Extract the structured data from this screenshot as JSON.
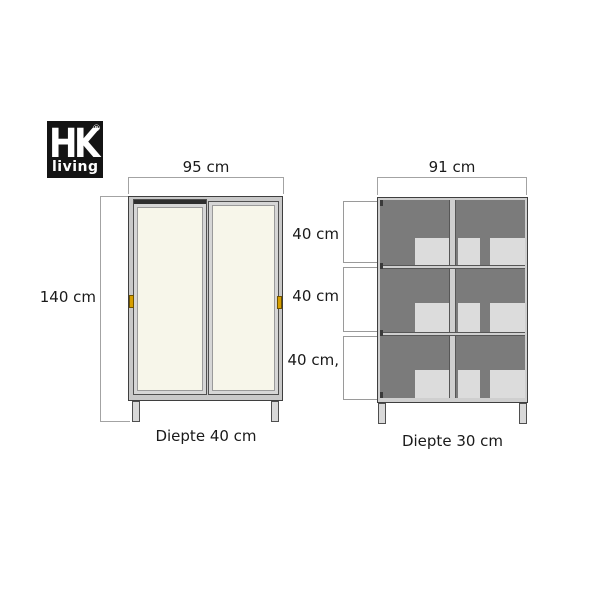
{
  "logo": {
    "brand": "HK",
    "registered": "®",
    "sub": "living",
    "background": "#141414",
    "text_color": "#ffffff"
  },
  "left_cabinet": {
    "width_label": "95 cm",
    "height_label": "140 cm",
    "depth_label": "Diepte 40 cm",
    "door_color": "#f7f6ea",
    "frame_color": "#c9c9c9",
    "handle_color": "#d79f00"
  },
  "right_cabinet": {
    "width_label": "91 cm",
    "depth_label": "Diepte 30 cm",
    "section_labels": [
      "40 cm",
      "40 cm",
      "40 cm,"
    ],
    "panel_color": "#7b7b7b",
    "content_color": "#dcdcdc",
    "frame_color": "#cfcfcf"
  },
  "diagram": {
    "line_color": "#a3a3a3",
    "text_color": "#1a1a1a",
    "background": "#ffffff"
  }
}
